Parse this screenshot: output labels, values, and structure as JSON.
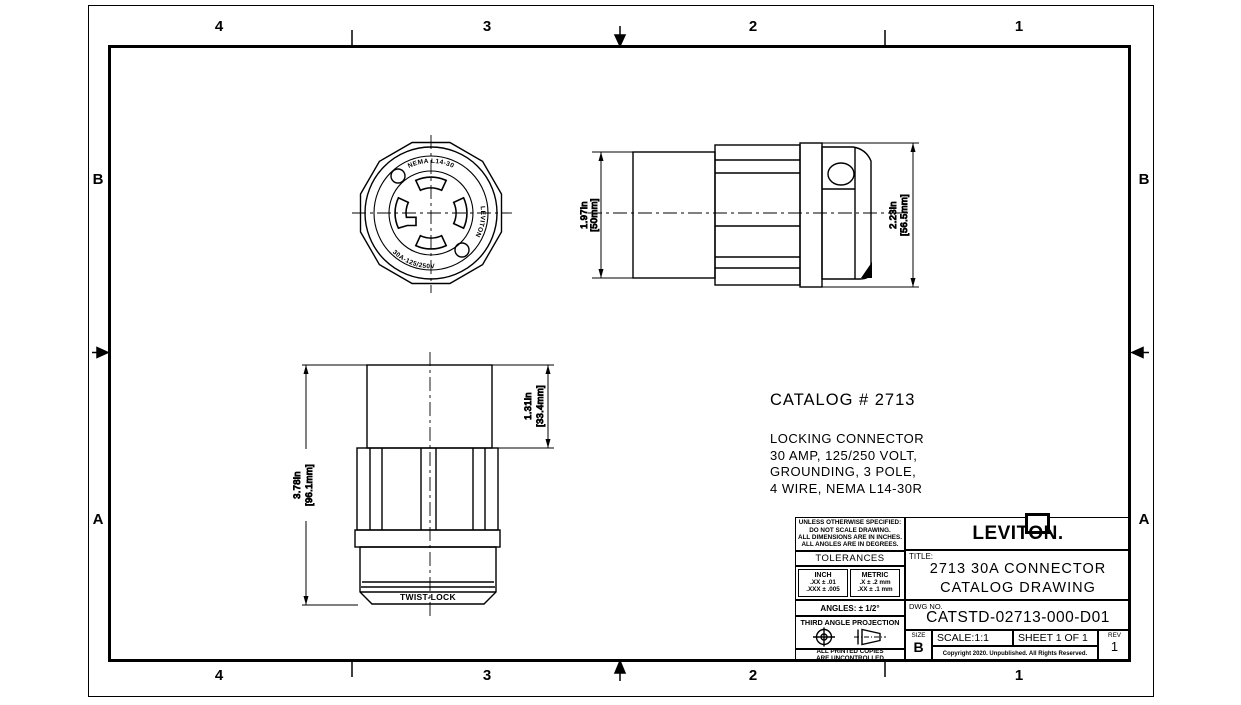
{
  "colors": {
    "ink": "#000000",
    "paper": "#ffffff"
  },
  "zones": {
    "top": [
      "4",
      "3",
      "2",
      "1"
    ],
    "bottom": [
      "4",
      "3",
      "2",
      "1"
    ],
    "left": [
      "B",
      "A"
    ],
    "right": [
      "B",
      "A"
    ]
  },
  "catalog": {
    "heading": "CATALOG # 2713",
    "description": [
      "LOCKING CONNECTOR",
      "30 AMP, 125/250 VOLT,",
      "GROUNDING, 3 POLE,",
      "4 WIRE, NEMA L14-30R"
    ]
  },
  "dimensions": {
    "sleeve_od": {
      "in": "1.97in",
      "mm": "[50mm]"
    },
    "overall_od": {
      "in": "2.23in",
      "mm": "[56.5mm]"
    },
    "overall_length": {
      "in": "3.78in",
      "mm": "[96.1mm]"
    },
    "cord_sleeve_length": {
      "in": "1.31in",
      "mm": "[33.4mm]"
    }
  },
  "face_markings": {
    "top": "NEMA L14-30",
    "right": "LEVITON",
    "bottom": "30A-125/250V"
  },
  "body_marking": "TWIST-LOCK",
  "title_block": {
    "notes": [
      "UNLESS OTHERWISE SPECIFIED:",
      "DO NOT SCALE DRAWING.",
      "ALL DIMENSIONS ARE IN INCHES.",
      "ALL ANGLES ARE IN DEGREES."
    ],
    "tolerances_header": "TOLERANCES",
    "inch_header": "INCH",
    "inch_rows": [
      ".XX ± .01",
      ".XXX ± .005"
    ],
    "metric_header": "METRIC",
    "metric_rows": [
      ".X ± .2 mm",
      ".XX ± .1 mm"
    ],
    "angles": "ANGLES: ± 1/2°",
    "projection_label": "THIRD ANGLE PROJECTION",
    "uncontrolled": [
      "ALL PRINTED COPIES",
      "ARE UNCONTROLLED"
    ],
    "brand": "LEVITON.",
    "title_label": "TITLE:",
    "title_lines": [
      "2713 30A CONNECTOR",
      "CATALOG DRAWING"
    ],
    "dwg_label": "DWG NO.",
    "dwg_no": "CATSTD-02713-000-D01",
    "size_label": "SIZE",
    "size": "B",
    "scale": "SCALE:1:1",
    "sheet": "SHEET 1 OF 1",
    "rev_label": "REV",
    "rev": "1",
    "copyright": "Copyright 2020. Unpublished. All Rights Reserved."
  }
}
